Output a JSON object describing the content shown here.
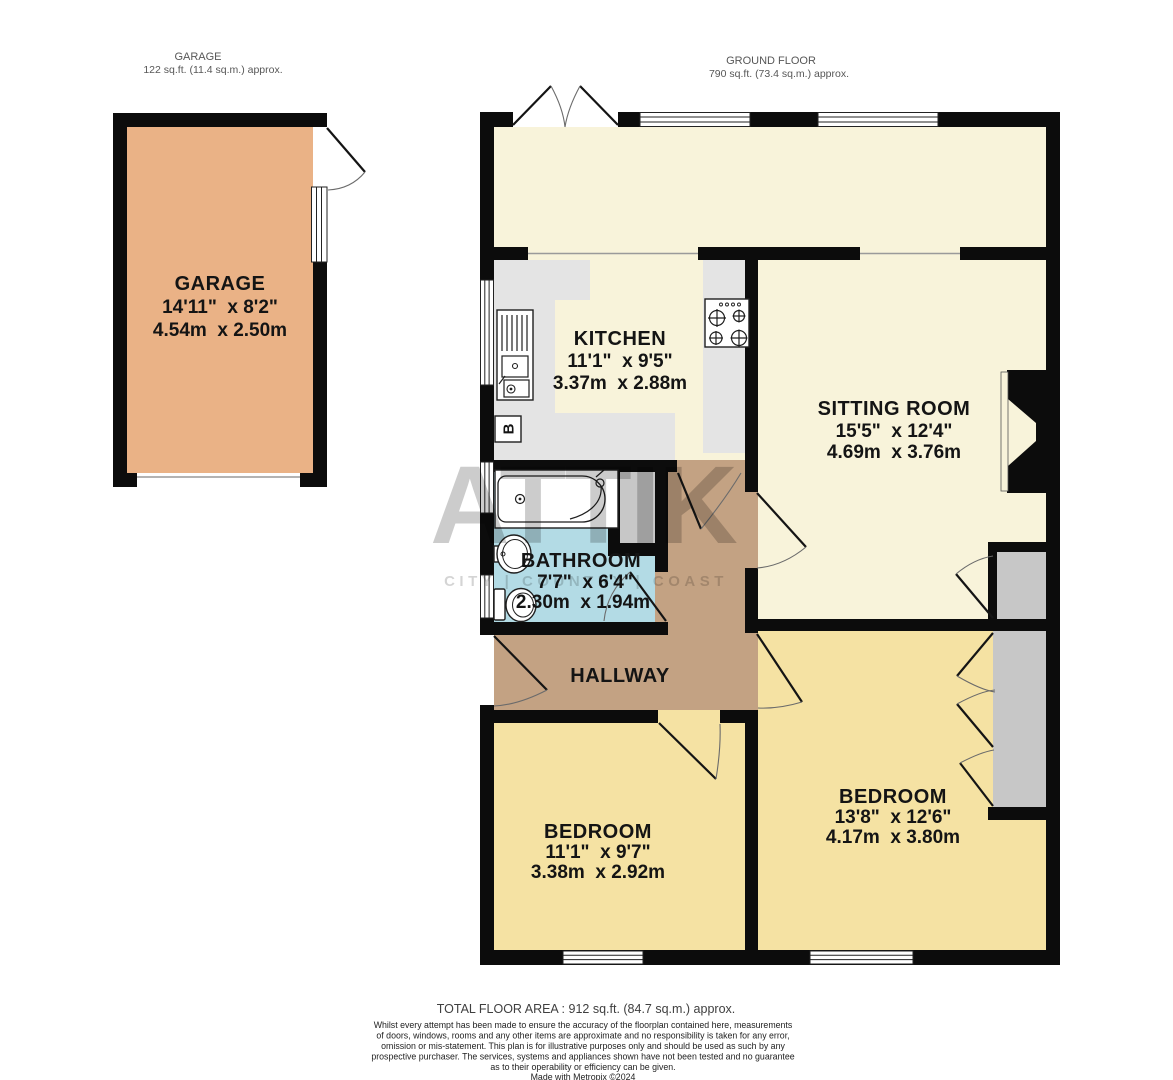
{
  "headers": {
    "garage": {
      "title": "GARAGE",
      "subtitle": "122 sq.ft. (11.4 sq.m.) approx."
    },
    "ground_floor": {
      "title": "GROUND FLOOR",
      "subtitle": "790 sq.ft. (73.4 sq.m.) approx."
    }
  },
  "rooms": {
    "garage": {
      "name": "GARAGE",
      "imperial": "14'11\"  x 8'2\"",
      "metric": "4.54m  x 2.50m"
    },
    "kitchen": {
      "name": "KITCHEN",
      "imperial": "11'1\"  x 9'5\"",
      "metric": "3.37m  x 2.88m"
    },
    "sitting_room": {
      "name": "SITTING ROOM",
      "imperial": "15'5\"  x 12'4\"",
      "metric": "4.69m  x 3.76m"
    },
    "bathroom": {
      "name": "BATHROOM",
      "imperial": "7'7\"  x 6'4\"",
      "metric": "2.30m  x 1.94m"
    },
    "hallway": {
      "name": "HALLWAY"
    },
    "bedroom_left": {
      "name": "BEDROOM",
      "imperial": "11'1\"  x 9'7\"",
      "metric": "3.38m  x 2.92m"
    },
    "bedroom_right": {
      "name": "BEDROOM",
      "imperial": "13'8\"  x 12'6\"",
      "metric": "4.17m  x 3.80m"
    }
  },
  "fixtures": {
    "boiler_label": "B"
  },
  "watermark": {
    "brand": "ATTIK",
    "tagline": "CITY | COUNTRY | COAST"
  },
  "footer": {
    "total_area": "TOTAL FLOOR AREA : 912 sq.ft. (84.7 sq.m.) approx.",
    "disclaimer_lines": [
      "Whilst every attempt has been made to ensure the accuracy of the floorplan contained here, measurements",
      "of doors, windows, rooms and any other items are approximate and no responsibility is taken for any error,",
      "omission or mis-statement. This plan is for illustrative purposes only and should be used as such by any",
      "prospective purchaser. The services, systems and appliances shown have not been tested and no guarantee",
      "as to their operability or efficiency can be given.",
      "Made with Metropix ©2024"
    ]
  },
  "colors": {
    "wall": "#0c0c0c",
    "room_cream": "#f8f3da",
    "bedroom_yellow": "#f5e2a3",
    "bathroom_blue": "#b3dbe5",
    "hallway_tan": "#c3a283",
    "garage_orange": "#eab286",
    "counter_gray": "#e4e4e4",
    "cupboard_gray": "#c7c7c7"
  }
}
